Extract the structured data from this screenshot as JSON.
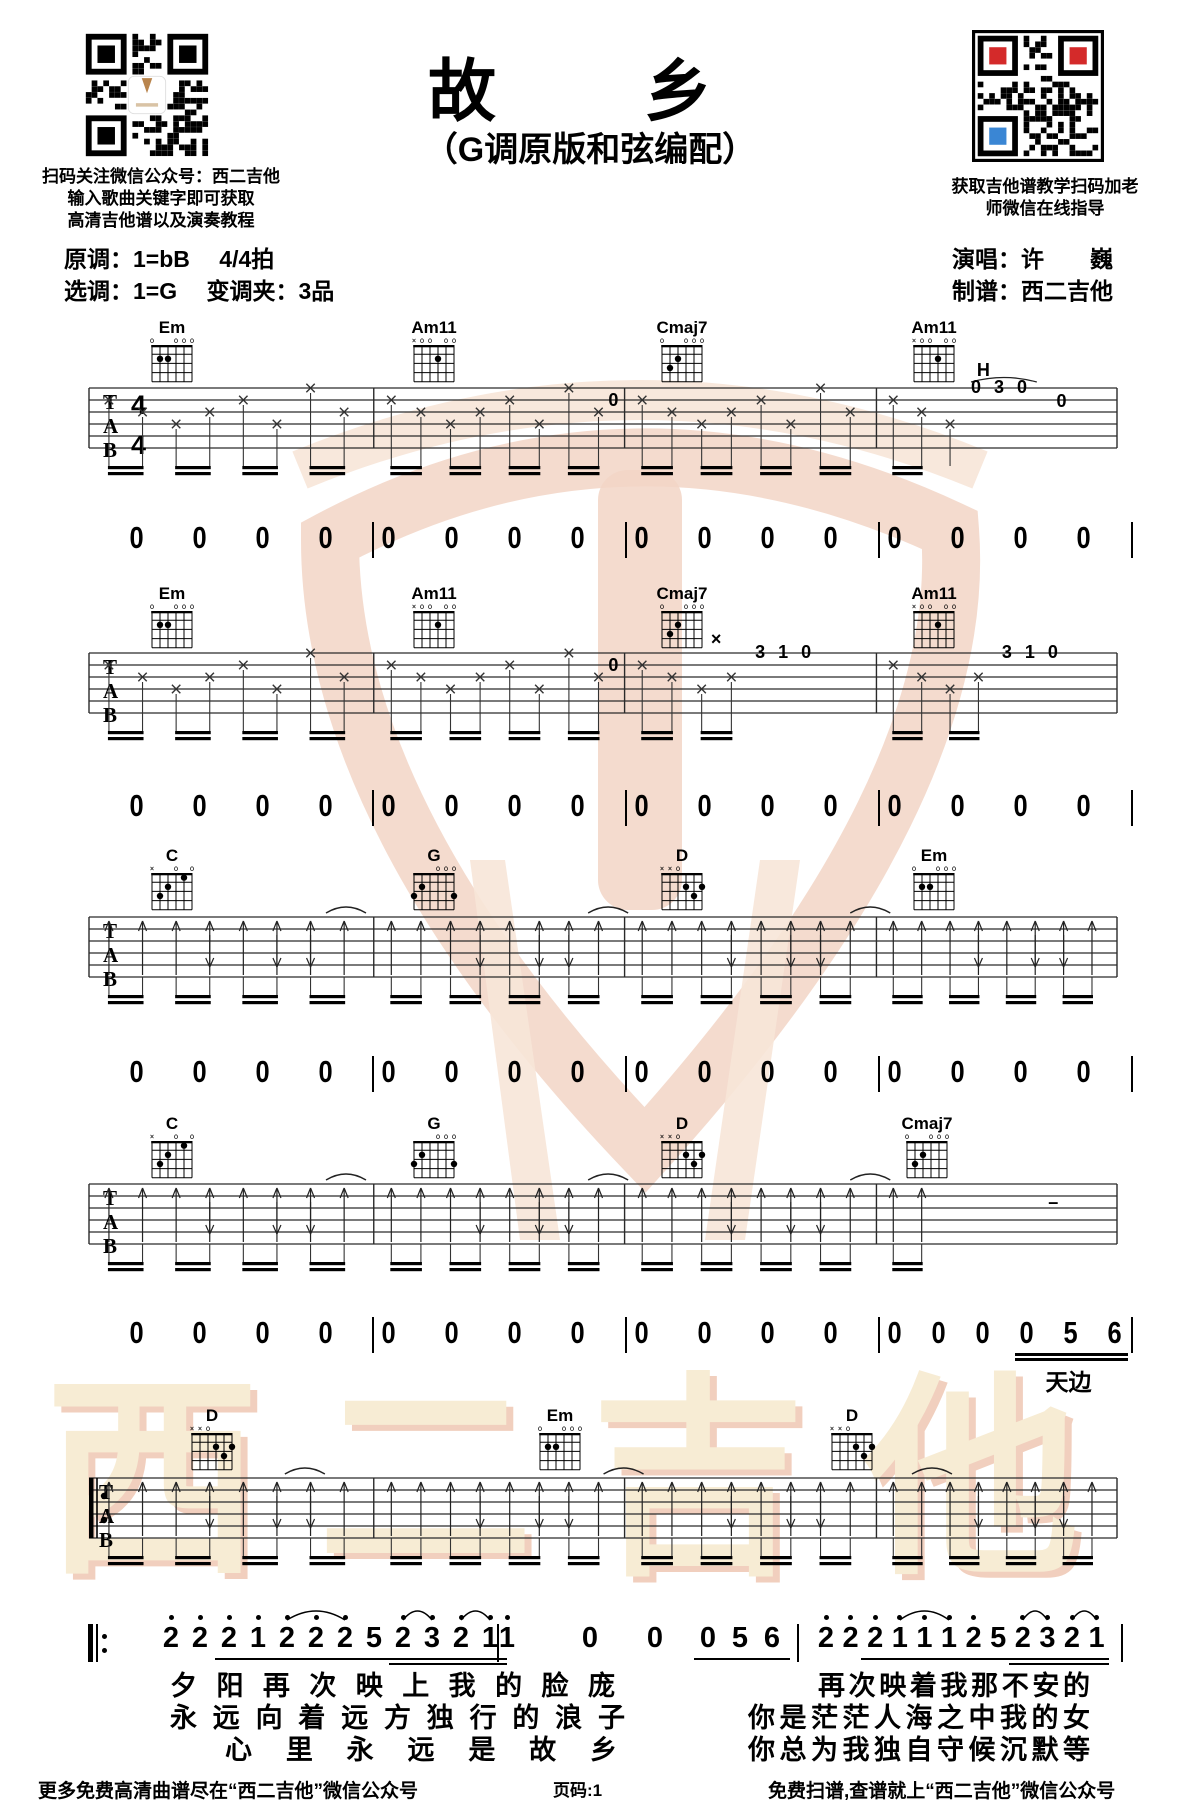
{
  "header": {
    "title": "故　乡",
    "subtitle": "（G调原版和弦编配）",
    "qr_left_caption": [
      "扫码关注微信公众号：西二吉他",
      "输入歌曲关键字即可获取",
      "高清吉他谱以及演奏教程"
    ],
    "qr_right_caption": [
      "获取吉他谱教学扫码加老",
      "师微信在线指导"
    ],
    "original_key": "原调：1=bB　 4/4拍",
    "selected_key": "选调：1=G　 变调夹：3品",
    "singer": "演唱：许　　巍",
    "arranger": "制谱：西二吉他"
  },
  "chords": {
    "Em": {
      "markers": [
        "o",
        "",
        "",
        "o",
        "o",
        "o"
      ],
      "dots": [
        [
          1,
          2
        ],
        [
          2,
          2
        ]
      ]
    },
    "Am11": {
      "markers": [
        "x",
        "o",
        "o",
        "",
        "o",
        "o"
      ],
      "dots": [
        [
          3,
          2
        ]
      ]
    },
    "Cmaj7": {
      "markers": [
        "o",
        "",
        "",
        "o",
        "o",
        "o"
      ],
      "dots": [
        [
          1,
          3
        ],
        [
          2,
          2
        ]
      ]
    },
    "C": {
      "markers": [
        "x",
        "",
        "",
        "o",
        "",
        "o"
      ],
      "dots": [
        [
          1,
          3
        ],
        [
          2,
          2
        ],
        [
          4,
          1
        ]
      ]
    },
    "G": {
      "markers": [
        "",
        "",
        "",
        "o",
        "o",
        "o"
      ],
      "dots": [
        [
          0,
          3
        ],
        [
          1,
          2
        ],
        [
          5,
          3
        ]
      ]
    },
    "D": {
      "markers": [
        "x",
        "x",
        "o",
        "",
        "",
        ""
      ],
      "dots": [
        [
          3,
          2
        ],
        [
          4,
          3
        ],
        [
          5,
          2
        ]
      ]
    }
  },
  "systems": [
    {
      "name": "system-1",
      "staff_y": 388,
      "pattern": "mute",
      "time_sig": "4/4",
      "chords": [
        {
          "chord": "Em",
          "x": 150
        },
        {
          "chord": "Am11",
          "x": 412
        },
        {
          "chord": "Cmaj7",
          "x": 660
        },
        {
          "chord": "Am11",
          "x": 912
        }
      ],
      "chord_y": 320,
      "annotations": [
        {
          "t": "H",
          "fx": 0.872,
          "y": 16
        },
        {
          "t": "0 3 0",
          "fx": 0.858,
          "y": 33
        },
        {
          "t": "0",
          "fx": 0.948,
          "y": 47
        },
        {
          "t": "0",
          "fx": 0.512,
          "y": 46
        }
      ],
      "annarcs": [
        [
          0.858,
          0.922,
          22
        ]
      ],
      "skips": [
        [
          0.84,
          1.0
        ]
      ]
    },
    {
      "name": "system-2",
      "staff_y": 653,
      "pattern": "mute",
      "chords": [
        {
          "chord": "Em",
          "x": 150
        },
        {
          "chord": "Am11",
          "x": 412
        },
        {
          "chord": "Cmaj7",
          "x": 660
        },
        {
          "chord": "Am11",
          "x": 912
        }
      ],
      "chord_y": 586,
      "annotations": [
        {
          "t": "3 1 0",
          "fx": 0.648,
          "y": 33
        },
        {
          "t": "3 1 0",
          "fx": 0.888,
          "y": 33
        },
        {
          "t": "0",
          "fx": 0.512,
          "y": 46
        },
        {
          "t": "×",
          "fx": 0.612,
          "y": 20
        }
      ],
      "annarcs": [],
      "skips": [
        [
          0.645,
          0.775
        ],
        [
          0.882,
          1.0
        ]
      ]
    },
    {
      "name": "system-3",
      "staff_y": 917,
      "pattern": "strum",
      "chords": [
        {
          "chord": "C",
          "x": 150
        },
        {
          "chord": "G",
          "x": 412
        },
        {
          "chord": "D",
          "x": 660
        },
        {
          "chord": "Em",
          "x": 912
        }
      ],
      "chord_y": 848,
      "annotations": [],
      "annarcs": [],
      "skips": [],
      "arcs": [
        0.25,
        0.505,
        0.76
      ]
    },
    {
      "name": "system-4",
      "staff_y": 1184,
      "pattern": "strum",
      "chords": [
        {
          "chord": "C",
          "x": 150
        },
        {
          "chord": "G",
          "x": 412
        },
        {
          "chord": "D",
          "x": 660
        },
        {
          "chord": "Cmaj7",
          "x": 905
        }
      ],
      "chord_y": 1116,
      "annotations": [
        {
          "t": "–",
          "fx": 0.94,
          "y": 52
        }
      ],
      "annarcs": [],
      "skips": [
        [
          0.82,
          1.0
        ]
      ],
      "arcs": [
        0.25,
        0.505,
        0.76
      ]
    },
    {
      "name": "system-5",
      "staff_y": 1478,
      "pattern": "strum",
      "repeat_start": true,
      "chords": [
        {
          "chord": "D",
          "x": 190
        },
        {
          "chord": "Em",
          "x": 538
        },
        {
          "chord": "D",
          "x": 830
        }
      ],
      "chord_y": 1408,
      "annotations": [],
      "annarcs": [],
      "skips": [],
      "arcs": [
        0.21,
        0.52,
        0.82
      ]
    }
  ],
  "count_rows": {
    "start_x": 120,
    "end_x": 1131,
    "barlines": [
      372,
      625,
      878,
      1131
    ],
    "rows": [
      {
        "y": 520,
        "groups": [
          [
            "0",
            "0",
            "0",
            "0"
          ],
          [
            "0",
            "0",
            "0",
            "0"
          ],
          [
            "0",
            "0",
            "0",
            "0"
          ],
          [
            "0",
            "0",
            "0",
            "0"
          ]
        ]
      },
      {
        "y": 788,
        "groups": [
          [
            "0",
            "0",
            "0",
            "0"
          ],
          [
            "0",
            "0",
            "0",
            "0"
          ],
          [
            "0",
            "0",
            "0",
            "0"
          ],
          [
            "0",
            "0",
            "0",
            "0"
          ]
        ]
      },
      {
        "y": 1054,
        "groups": [
          [
            "0",
            "0",
            "0",
            "0"
          ],
          [
            "0",
            "0",
            "0",
            "0"
          ],
          [
            "0",
            "0",
            "0",
            "0"
          ],
          [
            "0",
            "0",
            "0",
            "0"
          ]
        ]
      },
      {
        "y": 1315,
        "groups": [
          [
            "0",
            "0",
            "0",
            "0"
          ],
          [
            "0",
            "0",
            "0",
            "0"
          ],
          [
            "0",
            "0",
            "0",
            "0"
          ],
          [
            "0",
            "0",
            "0",
            "0",
            "5",
            "6"
          ]
        ],
        "underline_from": 3,
        "lyric": "天边"
      }
    ]
  },
  "jianpu": {
    "repeat_x": 88,
    "barlines": [
      497,
      797,
      1121
    ],
    "y": 1622,
    "measures": [
      {
        "x": 171,
        "step": 29,
        "notes": [
          {
            "n": "2",
            "d": 1
          },
          {
            "n": "2",
            "d": 1
          },
          {
            "n": "2",
            "d": 1,
            "u": 1
          },
          {
            "n": "1",
            "d": 1,
            "u": 1
          },
          {
            "n": "2",
            "d": 1,
            "u": 1
          },
          {
            "n": "2",
            "d": 1,
            "u": 1
          },
          {
            "n": "2",
            "d": 1,
            "u": 1
          },
          {
            "n": "5",
            "u": 1
          },
          {
            "n": "2",
            "d": 1,
            "u": 2
          },
          {
            "n": "3",
            "d": 1,
            "u": 2
          },
          {
            "n": "2",
            "d": 1,
            "u": 2
          },
          {
            "n": "1",
            "d": 1,
            "u": 2
          }
        ],
        "arcs": [
          [
            4,
            6
          ],
          [
            8,
            9
          ],
          [
            10,
            11
          ]
        ]
      },
      {
        "xs": [
          507,
          590,
          655,
          708,
          740,
          772
        ],
        "notes": [
          {
            "n": "1",
            "d": 1
          },
          {
            "n": "0"
          },
          {
            "n": "0"
          },
          {
            "n": "0",
            "u": 1
          },
          {
            "n": "5",
            "u": 1
          },
          {
            "n": "6",
            "u": 1
          }
        ],
        "arcs": []
      },
      {
        "x": 826,
        "step": 24.6,
        "notes": [
          {
            "n": "2",
            "d": 1
          },
          {
            "n": "2",
            "d": 1
          },
          {
            "n": "2",
            "d": 1,
            "u": 1
          },
          {
            "n": "1",
            "d": 1,
            "u": 1
          },
          {
            "n": "1",
            "d": 1,
            "u": 1
          },
          {
            "n": "1",
            "d": 1,
            "u": 1
          },
          {
            "n": "2",
            "d": 1,
            "u": 1
          },
          {
            "n": "5",
            "u": 1
          },
          {
            "n": "2",
            "d": 1,
            "u": 2
          },
          {
            "n": "3",
            "d": 1,
            "u": 2
          },
          {
            "n": "2",
            "d": 1,
            "u": 2
          },
          {
            "n": "1",
            "d": 1,
            "u": 2
          }
        ],
        "arcs": [
          [
            3,
            5
          ],
          [
            8,
            9
          ],
          [
            10,
            11
          ]
        ]
      }
    ]
  },
  "lyrics": [
    {
      "x": 170,
      "w": 445,
      "y": 1672,
      "text": "夕阳再次映上我的脸庞"
    },
    {
      "x": 170,
      "w": 455,
      "y": 1704,
      "text": "永远向着远方独行的浪子"
    },
    {
      "x": 225,
      "w": 392,
      "y": 1736,
      "text": "心里永远是故乡"
    },
    {
      "x": 818,
      "w": 272,
      "y": 1672,
      "text": "再次映着我那不安的"
    },
    {
      "x": 748,
      "w": 342,
      "y": 1704,
      "text": "你是茫茫人海之中我的女"
    },
    {
      "x": 748,
      "w": 342,
      "y": 1736,
      "text": "你总为我独自守候沉默等"
    }
  ],
  "footer": {
    "left": "更多免费高清曲谱尽在“西二吉他”微信公众号",
    "center": "页码:1",
    "right": "免费扫谱,查谱就上“西二吉他”微信公众号"
  },
  "watermark": {
    "bottom_text": "西二吉他",
    "logo_color": "#f2d5c6",
    "logo_light": "#f7e5d8",
    "text_color": "#f7ecd4",
    "shadow_color": "#f1cfbe"
  },
  "qr": {
    "finder_left": [
      "#000000",
      "#000000",
      "#000000"
    ],
    "finder_right": [
      "#d42a2a",
      "#d42a2a",
      "#3a86d4"
    ]
  }
}
